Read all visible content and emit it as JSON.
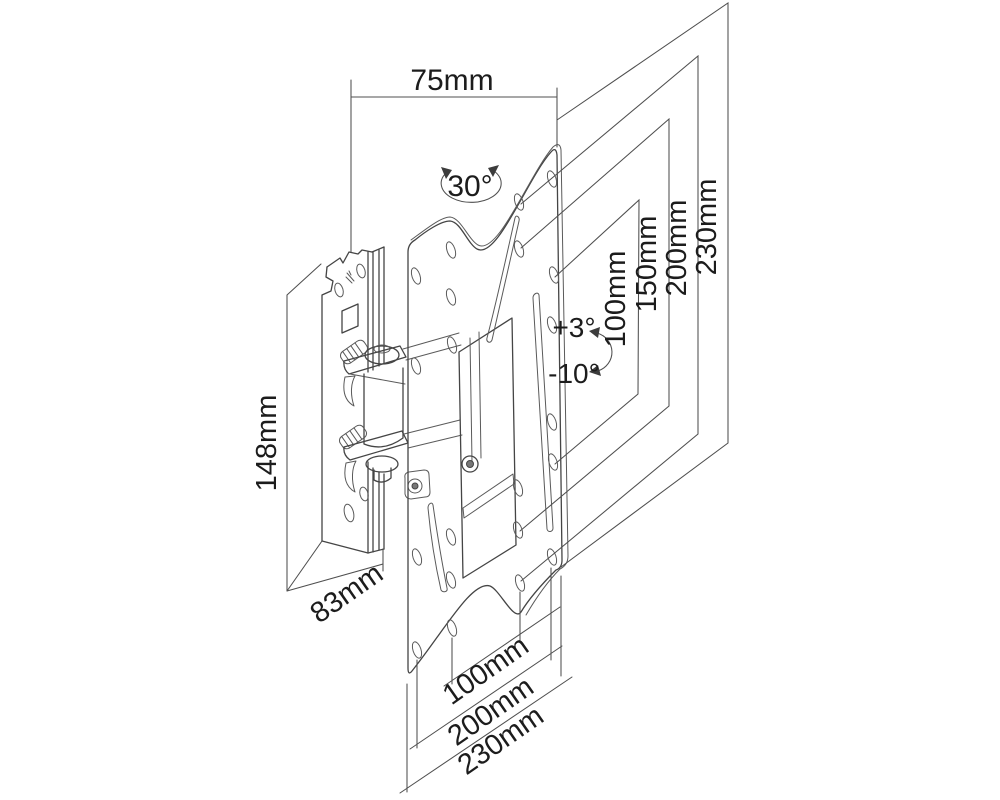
{
  "diagram": {
    "background": "#ffffff",
    "line_color": "#454545",
    "text_color": "#1c1c1c",
    "labels": {
      "width_top": "75mm",
      "swivel": "30°",
      "height_left": "148mm",
      "depth_left": "83mm",
      "tilt_up": "+3°",
      "tilt_down": "-10°",
      "vesa_vertical": [
        "100mm",
        "150mm",
        "200mm",
        "230mm"
      ],
      "vesa_horizontal": [
        "100mm",
        "200mm",
        "230mm"
      ]
    }
  }
}
